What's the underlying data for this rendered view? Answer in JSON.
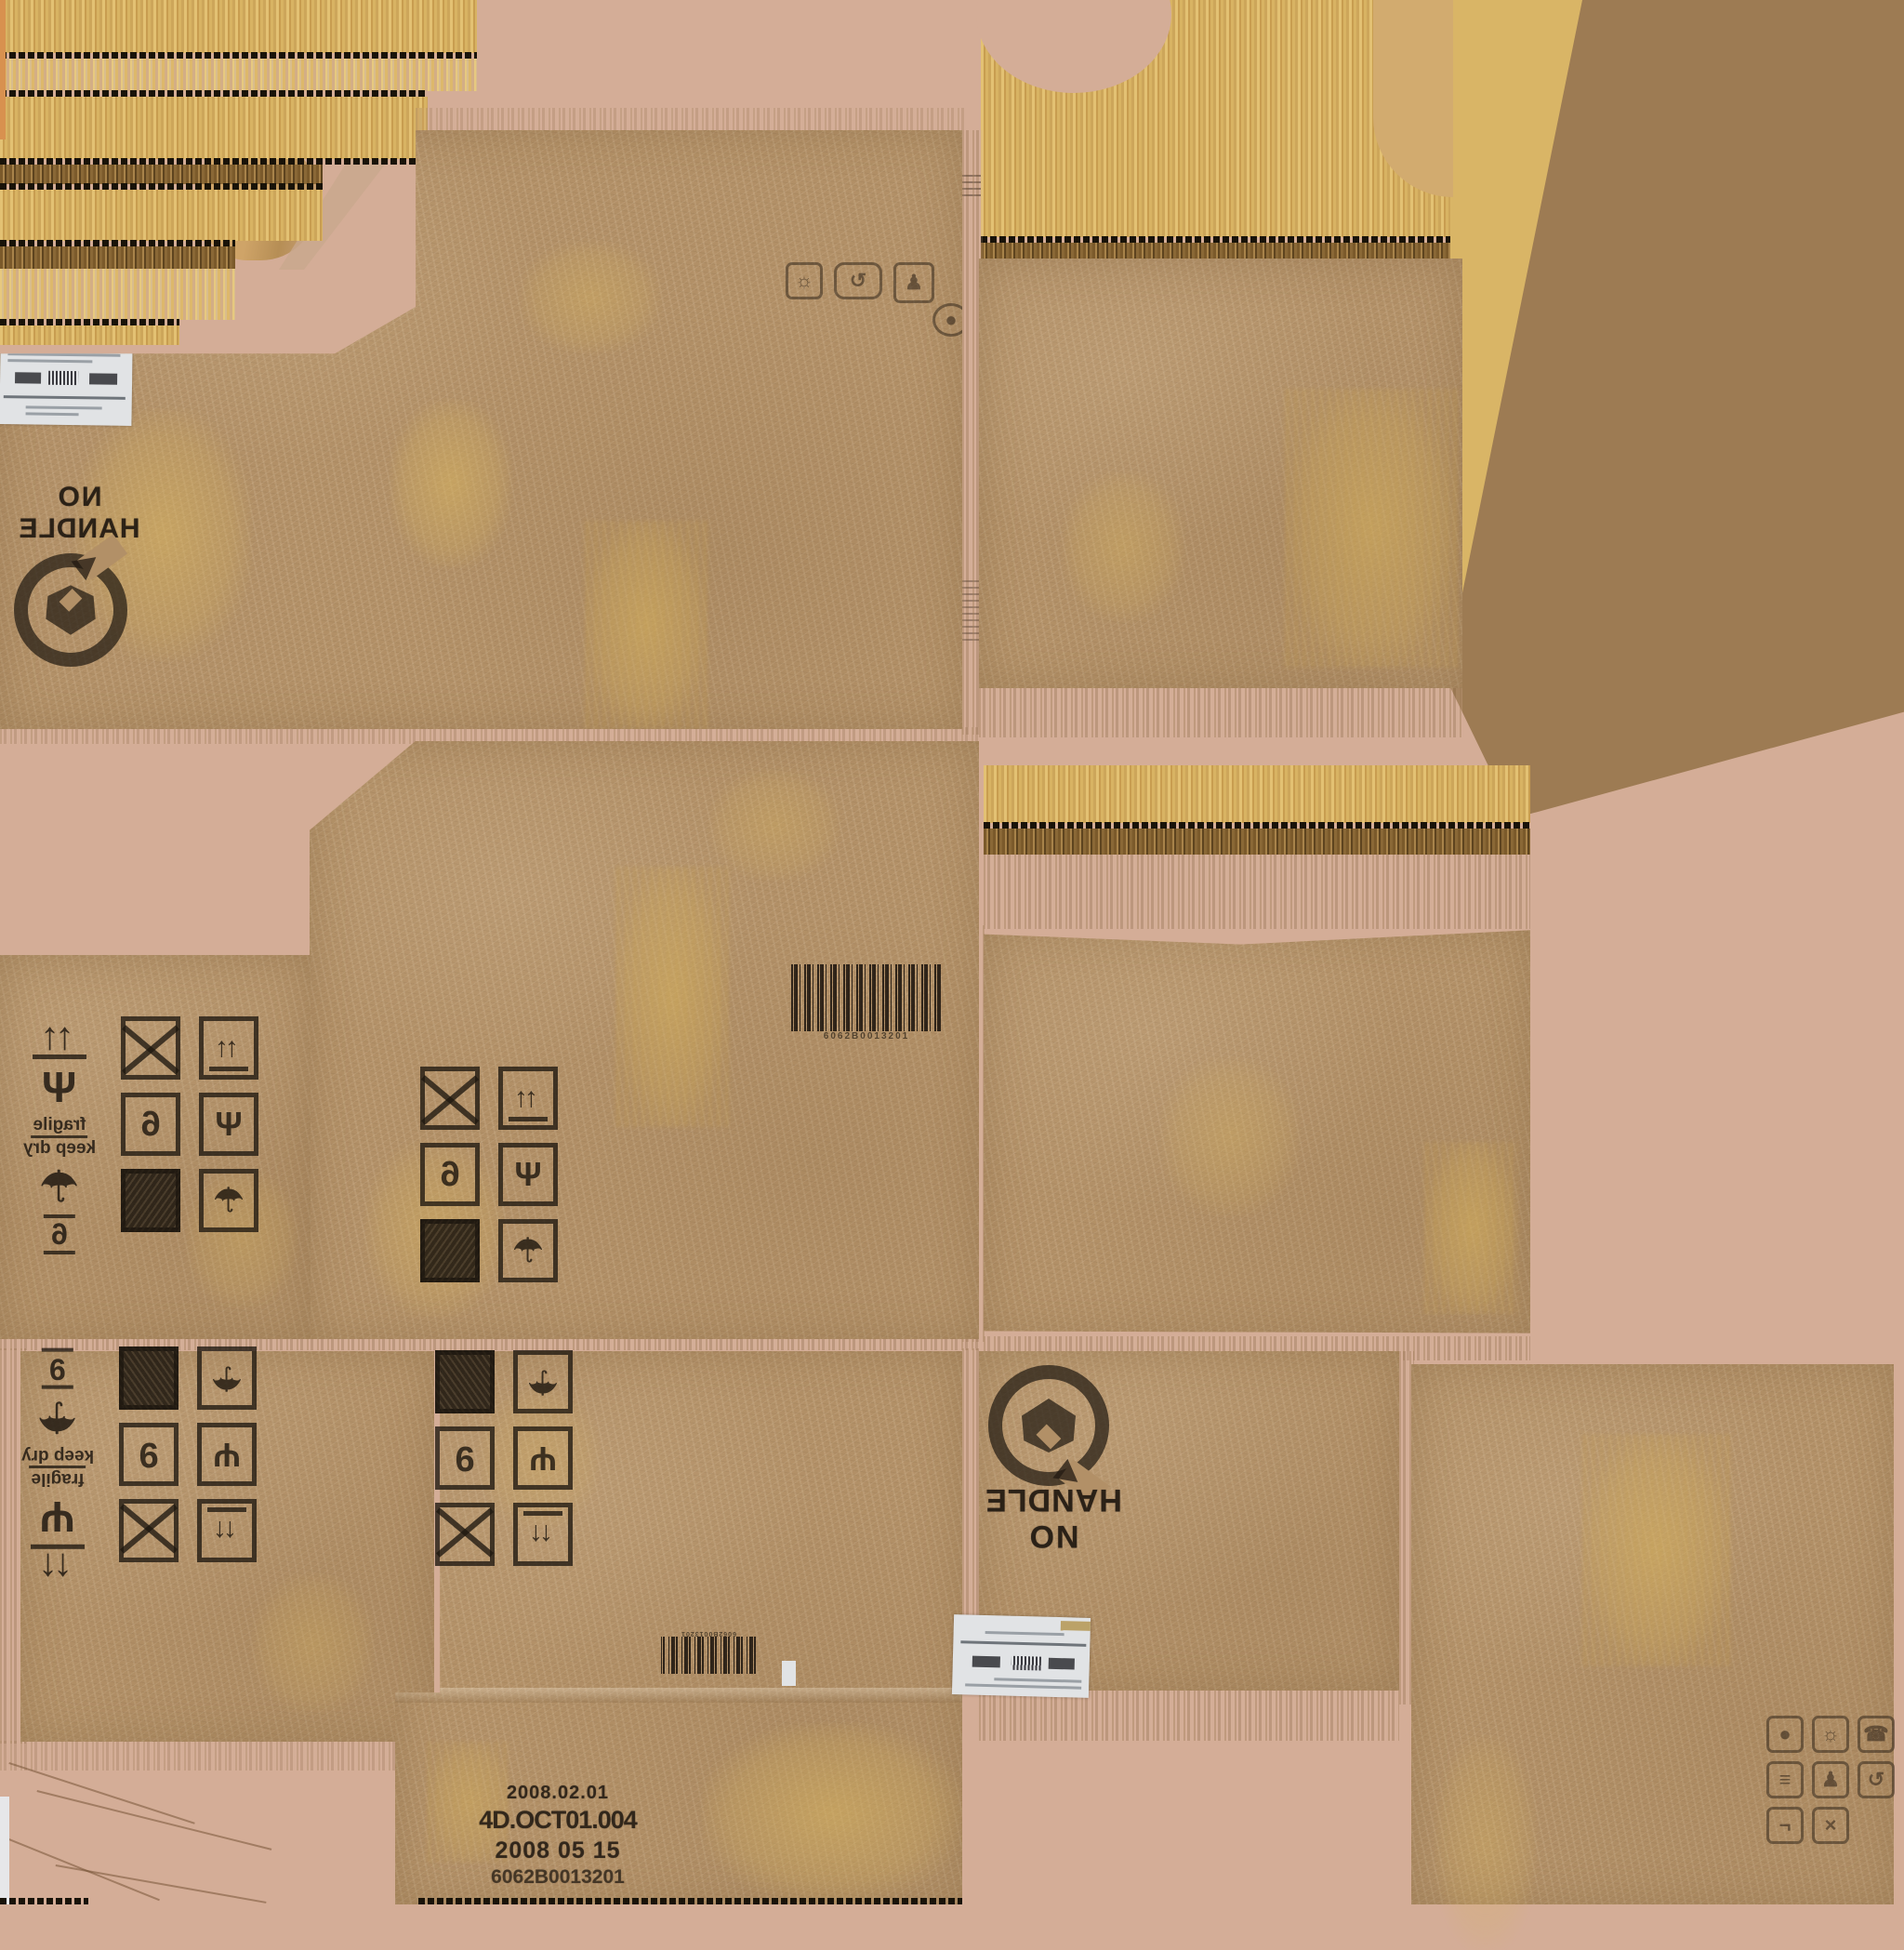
{
  "title": "cardboard box diffuse texture atlas",
  "colors": {
    "background_pink": "#d4ad97",
    "cardboard": "#b29067",
    "corrugation_yellow": "#ddb766",
    "corrugation_dark": "#7b5a2b",
    "flat_brown": "#9d7b53",
    "wedge_yellow": "#d9b566",
    "stamp_ink": "#241c13",
    "label_white": "#e1e3e5",
    "stain_yellow": "#d6b25e",
    "orange_sliver": "#d8914f"
  },
  "stamps": {
    "no_handle": {
      "line1": "NO",
      "line2": "HANDLE"
    },
    "fragile_label": {
      "line1": "fragile",
      "line2": "keep dry"
    },
    "production": {
      "line1": "2008.02.01",
      "line2": "4D.OCT01.004",
      "line3": "2008 05 15",
      "line4": "6062B0013201"
    },
    "barcode_caption": "6062B0013201"
  },
  "icon_glyphs": {
    "up-arrows": "↑↑",
    "wine-glass": "Ψ",
    "umbrella": "☂",
    "cross": "×",
    "starburst": "☼",
    "loop": "↺",
    "figure": "♟",
    "hand": "●",
    "phone": "☎",
    "lines": "≡",
    "bracket": "¬"
  },
  "handling_grids": [
    {
      "id": "middle-left-mirrored",
      "transform": "flip",
      "digit": "6",
      "loose": [
        "up-arrows",
        "wine-glass",
        "fragile-text",
        "umbrella",
        "six-lines"
      ],
      "columns": [
        [
          "crossed-box",
          "digit-box",
          "solid-box"
        ],
        [
          "up-arrows-box",
          "wine-glass-box",
          "umbrella-box"
        ]
      ]
    },
    {
      "id": "middle-panel-mirrored",
      "transform": "flip",
      "digit": "6",
      "loose": [],
      "columns": [
        [
          "crossed-box",
          "digit-box",
          "solid-box"
        ],
        [
          "up-arrows-box",
          "wine-glass-box",
          "umbrella-box"
        ]
      ]
    },
    {
      "id": "bottom-left-rotated",
      "transform": "rot",
      "digit": "9",
      "loose": [
        "six-lines",
        "umbrella",
        "fragile-text",
        "wine-glass",
        "up-arrows"
      ],
      "columns": [
        [
          "solid-box",
          "digit-box",
          "crossed-box"
        ],
        [
          "umbrella-box",
          "wine-glass-box",
          "up-arrows-box"
        ]
      ]
    },
    {
      "id": "bottom-panel-rotated",
      "transform": "rot",
      "digit": "9",
      "loose": [],
      "columns": [
        [
          "solid-box",
          "digit-box",
          "crossed-box"
        ],
        [
          "umbrella-box",
          "wine-glass-box",
          "up-arrows-box"
        ]
      ]
    }
  ],
  "misc_icons": {
    "top_panel_icons": [
      "starburst",
      "loop",
      "figure",
      "hand"
    ],
    "bottom_right_icons": [
      "hand",
      "starburst",
      "phone",
      "lines",
      "figure",
      "loop",
      "bracket",
      "cross",
      "blank"
    ]
  }
}
